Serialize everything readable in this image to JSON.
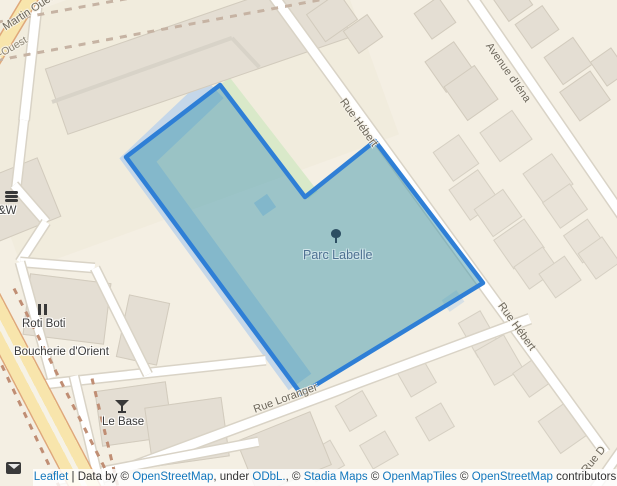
{
  "map": {
    "park": {
      "name": "Parc Labelle",
      "polygon_points": "220,85 305,197 375,141 483,283 301,394 126,157"
    },
    "street_labels": {
      "martin_ouest": "Martin Ouest",
      "ouest_partial": "n-Ouest",
      "rue_hebert_north": "Rue Hébert",
      "rue_hebert_south": "Rue Hébert",
      "avenue_iena": "Avenue d'Iéna",
      "rue_loranger": "Rue Loranger",
      "rue_d_partial": "Rue D"
    },
    "pois": {
      "aw_partial": "&W",
      "roti_boti": "Roti Boti",
      "boucherie": "Boucherie d'Orient",
      "le_base": "Le Base"
    },
    "icons": [
      "burger-icon",
      "restaurant-icon",
      "bar-icon",
      "tree-icon",
      "envelope-icon"
    ],
    "colors": {
      "selection_stroke": "#2f7fd6",
      "selection_fill": "rgba(68,153,174,0.5)",
      "park_underlay": "#c5d7e9",
      "grass_strip": "#d9e9c9",
      "land": "#f4efe3",
      "building": "#e4ded3",
      "road_major_fill": "#f8e5ac",
      "road_major_casing": "#dfa87a",
      "link_blue": "#1277bd"
    }
  },
  "attribution": {
    "segments": [
      {
        "text": "Leaflet",
        "link": true
      },
      {
        "text": " | Data by © ",
        "link": false
      },
      {
        "text": "OpenStreetMap",
        "link": true
      },
      {
        "text": ", under ",
        "link": false
      },
      {
        "text": "ODbL.",
        "link": true
      },
      {
        "text": ", © ",
        "link": false
      },
      {
        "text": "Stadia Maps",
        "link": true
      },
      {
        "text": " © ",
        "link": false
      },
      {
        "text": "OpenMapTiles",
        "link": true
      },
      {
        "text": " © ",
        "link": false
      },
      {
        "text": "OpenStreetMap",
        "link": true
      },
      {
        "text": " contributors",
        "link": false
      }
    ]
  }
}
